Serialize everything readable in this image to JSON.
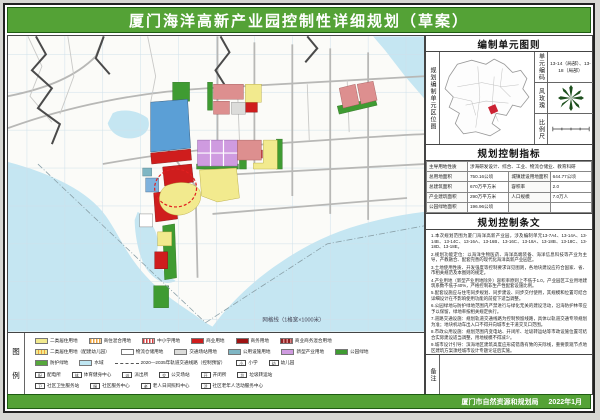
{
  "title": "厦门海洋高新产业园控制性详细规划（草案）",
  "colors": {
    "header_green": "#54a236",
    "water_blue": "#c5e6f2",
    "parcel_blue": "#5b9fd6",
    "parcel_red": "#cf1d1d",
    "parcel_yellow": "#f2ea8e",
    "parcel_violet": "#cf9be0",
    "parcel_pink": "#dd8f8f",
    "parcel_green": "#3f9b32",
    "highlight_red_dash": "#e02020"
  },
  "map": {
    "grid_note": "网格线（1格宽×1000米）"
  },
  "right_panel": {
    "unit_section": {
      "header": "编制单元图则",
      "side_label": "规划编制单元区位图",
      "code_label": "单元编码",
      "code_value": "13-14（局部）、13-18（局部）",
      "windrose_label": "风玫瑰",
      "scale_label": "比例尺"
    },
    "indicators": {
      "header": "规划控制指标",
      "rows": [
        {
          "label": "主导用地性质",
          "value": "涉海研发设计、综合、工业、物流仓储业、教育科研"
        },
        {
          "label": "总用地面积",
          "value": "750.16公顷",
          "label2": "城镇建设用地面积",
          "value2": "644.77公顷"
        },
        {
          "label": "总建筑面积",
          "value": "670万平方米",
          "label2": "容积率",
          "value2": "2.0"
        },
        {
          "label": "产业建筑面积",
          "value": "290万平方米",
          "label2": "人口规模",
          "value2": "7.0万人"
        },
        {
          "label": "公园绿地面积",
          "value": "196.96公顷",
          "label2": "",
          "value2": ""
        }
      ]
    },
    "provisions": {
      "header": "规划控制条文",
      "items": [
        "1.本次规划范围为厦门海洋高新产业园，涉及编制单元13-7A4、13-14A、13-14B、13-14C、13-16A、13-16B、13-16C、13-18A、13-18B、13-18C、13-18D、13-18E。",
        "2.规划功能定位：以海洋生物医药、海洋高端装备、海洋信息科技等产业为主导，产教融合、配套完善的现代化海洋高新产业园区。",
        "3.土地使用性质、开发强度等控制要求详见图则，各地块建设应符合国家、省、市相关规范及本图则的规定。",
        "4.产业用地（新型产业用地除外）容积率原则上不低于1.0，产业园区工业用地建筑系数不低于40%，严格控制非生产性配套设施比例。",
        "5.配套设施应与住宅同步规划、同步建设、同步交付使用，其规模和位置可结合详细设计在不影响使用功能的前提下适当调整。",
        "6.公园绿地与防护绿地范围内严禁进行与绿化无关的建设活动，沿海防护林带应予以保留，绿地率按相关规定执行。",
        "7.道路交通设施：规划轨道交通线路为控制预留线路，具体以轨道交通专项规划为准；地块机动车出入口不得开向城市主干道交叉口范围。",
        "8.市政公用设施：规划范围内变电站、开闭所、垃圾转运站等市政设施位置可结合实际建设适当调整，用地规模不得减少。",
        "9.城市设计引导：滨海地区建筑高度应形成错落有致的天际线，重要景观节点地区建筑方案须经城市设计专题论证后实施。",
        "10.本图则未尽事宜按照国家、省、市有关法律法规及技术规范执行；本图则自批准之日起施行，解释权归厦门市自然资源和规划局。"
      ]
    },
    "note_section": {
      "side_label": "备注"
    }
  },
  "legend": {
    "side_label": "图例",
    "rows": [
      [
        {
          "swatch": "yellow",
          "label": "二类居住用地"
        },
        {
          "swatch": "stripe-orange",
          "label": "商住混合用地"
        },
        {
          "swatch": "stripe-red",
          "label": "中小学用地"
        },
        {
          "swatch": "red",
          "label": "商业用地"
        },
        {
          "swatch": "darkred",
          "label": "商务用地"
        },
        {
          "swatch": "stripe-maroon",
          "label": "商业商务混合用地"
        }
      ],
      [
        {
          "swatch": "stripe-yellow",
          "label": "二类居住用地（配建幼儿园）"
        },
        {
          "swatch": "white",
          "label": "物流仓储用地"
        },
        {
          "swatch": "gray",
          "label": "交通场站用地"
        },
        {
          "swatch": "teal",
          "label": "公用设施用地"
        },
        {
          "swatch": "violet",
          "label": "新型产业用地"
        },
        {
          "swatch": "green",
          "label": "公园绿地"
        }
      ],
      [
        {
          "swatch": "green2",
          "label": "防护绿地"
        },
        {
          "swatch": "cyan",
          "label": "水域"
        },
        {
          "swatch": "rail",
          "label": "2020—2035年轨道交通线路（控制预留）"
        },
        {
          "swatch": "box",
          "mark": "小",
          "label": "小学"
        },
        {
          "swatch": "box",
          "mark": "幼",
          "label": "幼儿园"
        }
      ],
      [
        {
          "swatch": "box",
          "mark": "配",
          "label": "配电所"
        },
        {
          "swatch": "box",
          "mark": "体",
          "label": "体育健身中心"
        },
        {
          "swatch": "box",
          "mark": "派",
          "label": "派出所"
        },
        {
          "swatch": "box",
          "mark": "交",
          "label": "公交场站"
        },
        {
          "swatch": "box",
          "mark": "开",
          "label": "开闭所"
        },
        {
          "swatch": "box",
          "mark": "垃",
          "label": "垃圾转运站"
        }
      ],
      [
        {
          "swatch": "box",
          "mark": "卫",
          "label": "社区卫生服务站"
        },
        {
          "swatch": "box",
          "mark": "服",
          "label": "社区服务中心"
        },
        {
          "swatch": "box",
          "mark": "老",
          "label": "老人日间照料中心"
        },
        {
          "swatch": "box",
          "mark": "活",
          "label": "社区老年人活动服务中心"
        }
      ]
    ]
  },
  "footer": {
    "agency": "厦门市自然资源和规划局",
    "date": "2022年1月"
  }
}
